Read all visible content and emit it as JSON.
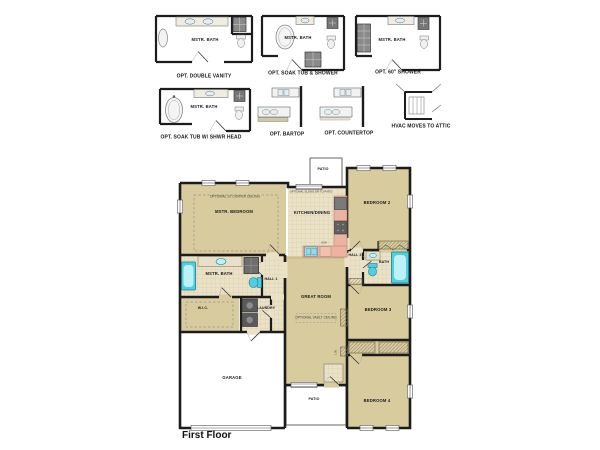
{
  "palette": {
    "wall": "#1c1c1c",
    "floor_tan": "#d8cb9e",
    "floor_tile": "#eae1c6",
    "counter_salmon": "#ecb2a2",
    "fixture_cyan": "#4ecfe2",
    "fixture_cyan_light": "#bdf0f7",
    "appliance_gray": "#5f5f5f",
    "background": "#ffffff"
  },
  "options": [
    {
      "caption": "OPT. DOUBLE VANITY",
      "room": "MSTR. BATH"
    },
    {
      "caption": "OPT. SOAK TUB & SHOWER",
      "room": "MSTR. BATH"
    },
    {
      "caption": "OPT. 60\" SHOWER",
      "room": "MSTR. BATH"
    },
    {
      "caption": "OPT. SOAK TUB W/ SHWR HEAD",
      "room": "MSTR. BATH"
    },
    {
      "caption": "OPT. BARTOP",
      "room": ""
    },
    {
      "caption": "OPT. COUNTERTOP",
      "room": ""
    },
    {
      "caption": "HVAC MOVES TO ATTIC",
      "room": ""
    }
  ],
  "floorplan": {
    "title": "First Floor",
    "rooms": {
      "mstr_bedroom": {
        "label": "MSTR. BEDROOM",
        "note": "OPTIONAL 12' COFFER CEILING"
      },
      "kitchen_dining": {
        "label": "KITCHEN/DINING",
        "note": "OPTIONAL SLDNG DR TO PATIO",
        "dw": "D/W"
      },
      "patio_rear": {
        "label": "PATIO"
      },
      "bedroom2": {
        "label": "BEDROOM 2"
      },
      "mstr_bath": {
        "label": "MSTR. BATH"
      },
      "wic": {
        "label": "W.I.C."
      },
      "hall1": {
        "label": "HALL 1"
      },
      "laundry": {
        "label": "LAUNDRY"
      },
      "great_room": {
        "label": "GREAT ROOM",
        "note": "OPTIONAL VAULT CEILING"
      },
      "hall2": {
        "label": "HALL 2"
      },
      "bath2": {
        "label": "BATH"
      },
      "bedroom3": {
        "label": "BEDROOM 3"
      },
      "linen": {
        "label": "LIN."
      },
      "garage": {
        "label": "GARAGE"
      },
      "patio_front": {
        "label": "PATIO"
      },
      "bedroom4": {
        "label": "BEDROOM 4"
      }
    }
  }
}
